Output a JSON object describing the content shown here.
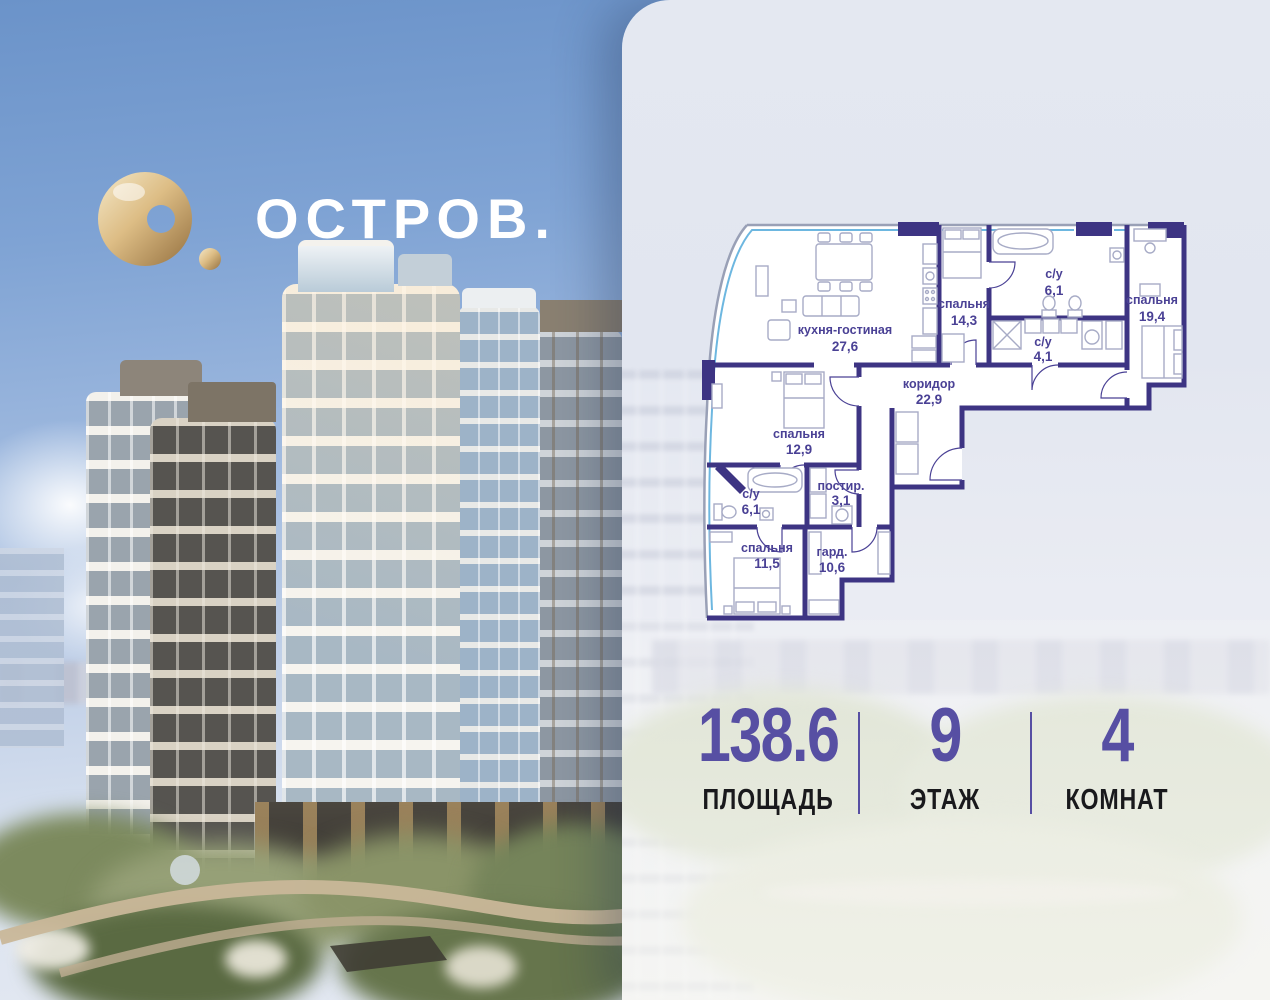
{
  "brand": {
    "name": "ОСТРОВ.",
    "logo_icon": "gold-torus-icon",
    "logo_color": "#d9b97f",
    "text_color": "#ffffff"
  },
  "floor_plan": {
    "type": "apartment-floorplan",
    "wall_color": "#3d3483",
    "glazing_color": "#6db7e0",
    "label_color": "#4a4195",
    "rooms": [
      {
        "name": "кухня-гостиная",
        "area": "27,6"
      },
      {
        "name": "спальня",
        "area": "14,3"
      },
      {
        "name": "с/у",
        "area": "6,1"
      },
      {
        "name": "спальня",
        "area": "19,4"
      },
      {
        "name": "с/у",
        "area": "4,1"
      },
      {
        "name": "коридор",
        "area": "22,9"
      },
      {
        "name": "спальня",
        "area": "12,9"
      },
      {
        "name": "с/у",
        "area": "6,1"
      },
      {
        "name": "постир.",
        "area": "3,1"
      },
      {
        "name": "спальня",
        "area": "11,5"
      },
      {
        "name": "гард.",
        "area": "10,6"
      }
    ]
  },
  "stats": {
    "accent_color": "#574fa3",
    "items": [
      {
        "value": "138.6",
        "label": "ПЛОЩАДЬ"
      },
      {
        "value": "9",
        "label": "ЭТАЖ"
      },
      {
        "value": "4",
        "label": "КОМНАТ"
      }
    ]
  }
}
